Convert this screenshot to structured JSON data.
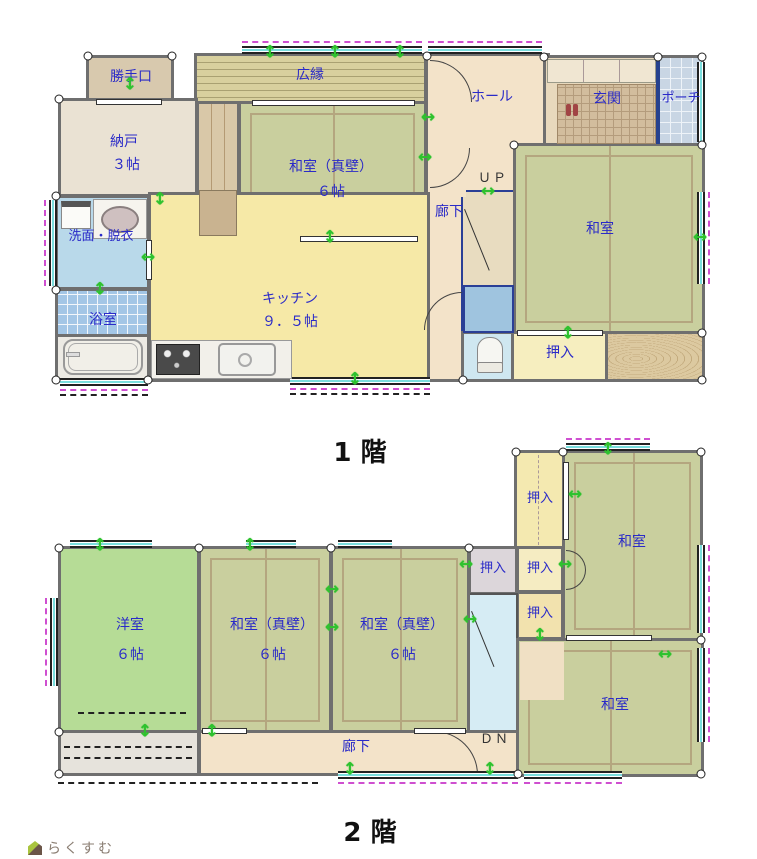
{
  "floor1_title": "1 階",
  "floor2_title": "2 階",
  "watermark": "らくすむ",
  "icons": {
    "arrow_v": "↕",
    "arrow_h": "↔"
  },
  "colors": {
    "room_label": "#2a2ac8",
    "wall": "#6f6f6f",
    "tatami": "#c9cf9e",
    "kitchen_yellow": "#f6e9a7",
    "hall_beige": "#f3e3c9",
    "vent_arrow_green": "#2ec22e",
    "window_dash_magenta": "#cf4fd0"
  },
  "floor1": {
    "katteguchi": "勝手口",
    "hiroen": "広縁",
    "hall": "ホール",
    "genkan": "玄関",
    "porch": "ポーチ",
    "nando": "納戸",
    "nando_size": "３帖",
    "washitsu_shinkabe": "和室（真壁）",
    "washitsu_shinkabe_size": "６帖",
    "roka": "廊下",
    "up": "ＵＰ",
    "washitsu": "和室",
    "senmen": "洗面・脱衣",
    "yokushitsu": "浴室",
    "kitchen": "キッチン",
    "kitchen_size": "９．５帖",
    "oshiire": "押入"
  },
  "floor2": {
    "oshiire_n": "押入",
    "washitsu_ne": "和室",
    "oshiire_w": "押入",
    "oshiire_m": "押入",
    "oshiire_s": "押入",
    "yoshitsu": "洋室",
    "yoshitsu_size": "６帖",
    "washitsu_shinkabe1": "和室（真壁）",
    "washitsu_shinkabe1_size": "６帖",
    "washitsu_shinkabe2": "和室（真壁）",
    "washitsu_shinkabe2_size": "６帖",
    "roka": "廊下",
    "dn": "ＤＮ",
    "washitsu_se": "和室"
  }
}
